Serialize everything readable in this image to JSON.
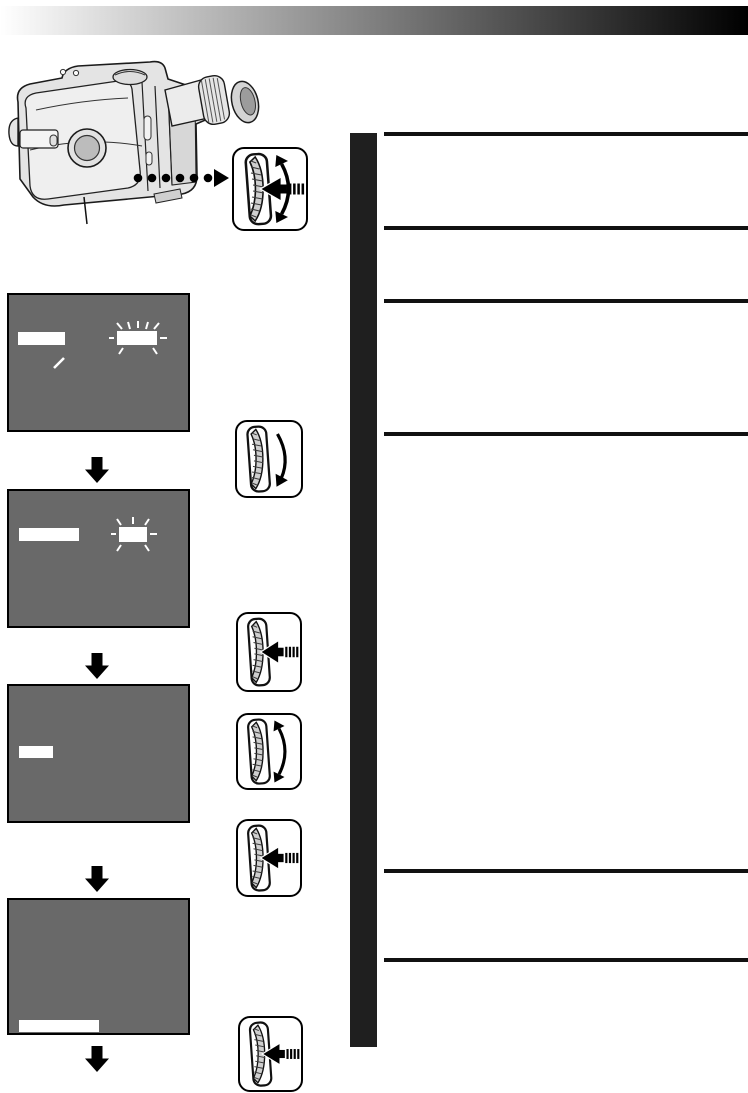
{
  "page": {
    "width_px": 748,
    "height_px": 1093,
    "description": "Camcorder instruction-manual page: camcorder illustration with control-dial callout, four gray display mock-ups with blank white indicator bars linked by flow arrows, dial gesture icons, and an empty ruled text column beside a black section bar"
  },
  "colors": {
    "page-bg": "#ffffff",
    "gradient-start": "#ffffff",
    "gradient-end": "#000000",
    "screen-bg": "#696969",
    "screen-border": "#000000",
    "indicator": "#ffffff",
    "icon-bg": "#ffffff",
    "icon-border": "#000000",
    "section-bar": "#1f1f1f",
    "rule": "#111111",
    "ink": "#111111"
  },
  "header": {
    "type": "gradient-banner",
    "text": ""
  },
  "illustration": {
    "subject": "camcorder-rear-left-view",
    "parts": [
      "body",
      "lens",
      "eyepiece-window",
      "viewfinder",
      "top-dial",
      "side-slats"
    ],
    "lens_callout_line": true,
    "dotted_leader": {
      "dot_count": 6,
      "arrowhead": "right",
      "target": "control-dial"
    }
  },
  "control_dial_legend": {
    "icon": "dial-rotate-and-press-icon",
    "gestures": [
      "rotate-up",
      "rotate-down",
      "press-in"
    ],
    "overlay_symbols": [
      "#sym-rotate-both",
      "#sym-press"
    ]
  },
  "procedure": {
    "screens": [
      {
        "id": 1,
        "indicators": [
          {
            "type": "bar",
            "position": "upper-left"
          },
          {
            "type": "slash-mark",
            "position": "below-left-bar"
          },
          {
            "type": "blinking-bar",
            "position": "upper-right"
          }
        ]
      },
      {
        "id": 2,
        "indicators": [
          {
            "type": "bar",
            "position": "upper-left"
          },
          {
            "type": "blinking-bar",
            "position": "upper-right"
          }
        ]
      },
      {
        "id": 3,
        "indicators": [
          {
            "type": "bar",
            "position": "middle-left"
          }
        ]
      },
      {
        "id": 4,
        "indicators": [
          {
            "type": "bar",
            "position": "bottom-left"
          }
        ]
      }
    ],
    "flow_arrow_count": 4,
    "dial_steps": [
      {
        "step": 1,
        "action": "rotate-down",
        "icon": "dial-rotate-down-icon",
        "symbol": "#sym-rotate-down"
      },
      {
        "step": 2,
        "action": "press",
        "icon": "dial-press-icon",
        "symbol": "#sym-press"
      },
      {
        "step": 3,
        "action": "rotate",
        "icon": "dial-rotate-icon",
        "symbol": "#sym-rotate-both"
      },
      {
        "step": 4,
        "action": "press",
        "icon": "dial-press-icon",
        "symbol": "#sym-press"
      },
      {
        "step": 5,
        "action": "press",
        "icon": "dial-press-icon",
        "symbol": "#sym-press"
      }
    ]
  },
  "right_column": {
    "section_bar": true,
    "rule_count": 6,
    "rule_y_px": [
      132,
      226,
      299,
      432,
      869,
      958
    ],
    "rows_text": [
      "",
      "",
      "",
      "",
      ""
    ]
  }
}
